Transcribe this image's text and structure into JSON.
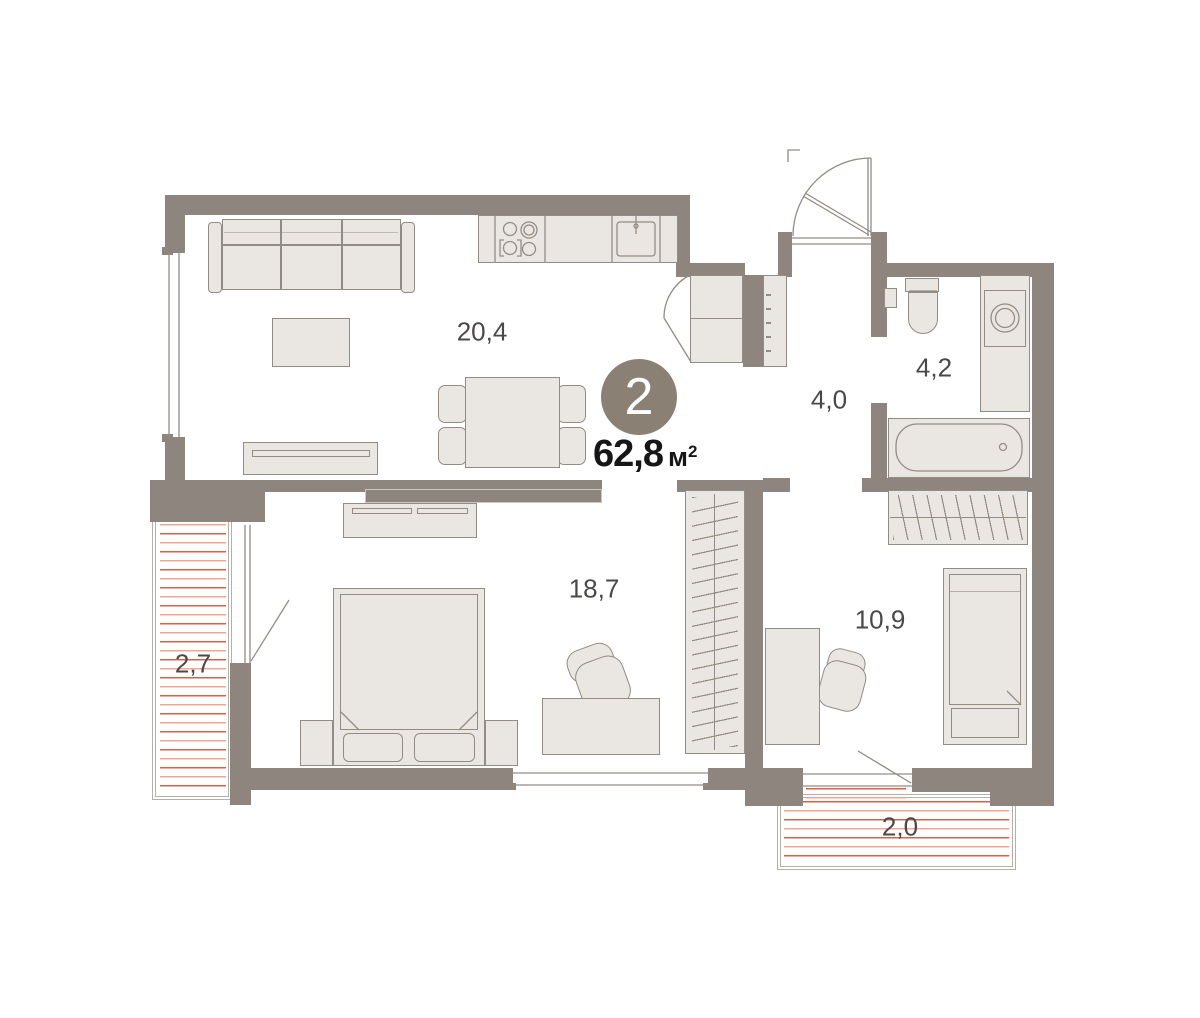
{
  "summary": {
    "room_count": "2",
    "area_value": "62,8",
    "area_unit": "м",
    "area_unit_sup": "2"
  },
  "rooms": {
    "living_kitchen": {
      "area": "20,4"
    },
    "hallway": {
      "area": "4,0"
    },
    "bathroom": {
      "area": "4,2"
    },
    "bedroom": {
      "area": "18,7"
    },
    "bedroom_2": {
      "area": "10,9"
    },
    "balcony_left": {
      "area": "2,7"
    },
    "balcony_bottom": {
      "area": "2,0"
    }
  },
  "colors": {
    "wall": "#8e867e",
    "furn-fill": "#eae7e2",
    "furn-stroke": "#938c84",
    "rad-dark": "#db5f45",
    "rad-light": "#f3a492",
    "label": "#4b4947",
    "area-text": "#161616",
    "badge-bg": "#8a8174",
    "panel-border": "#ccc7c1",
    "balcony-border": "#b4afa9"
  }
}
